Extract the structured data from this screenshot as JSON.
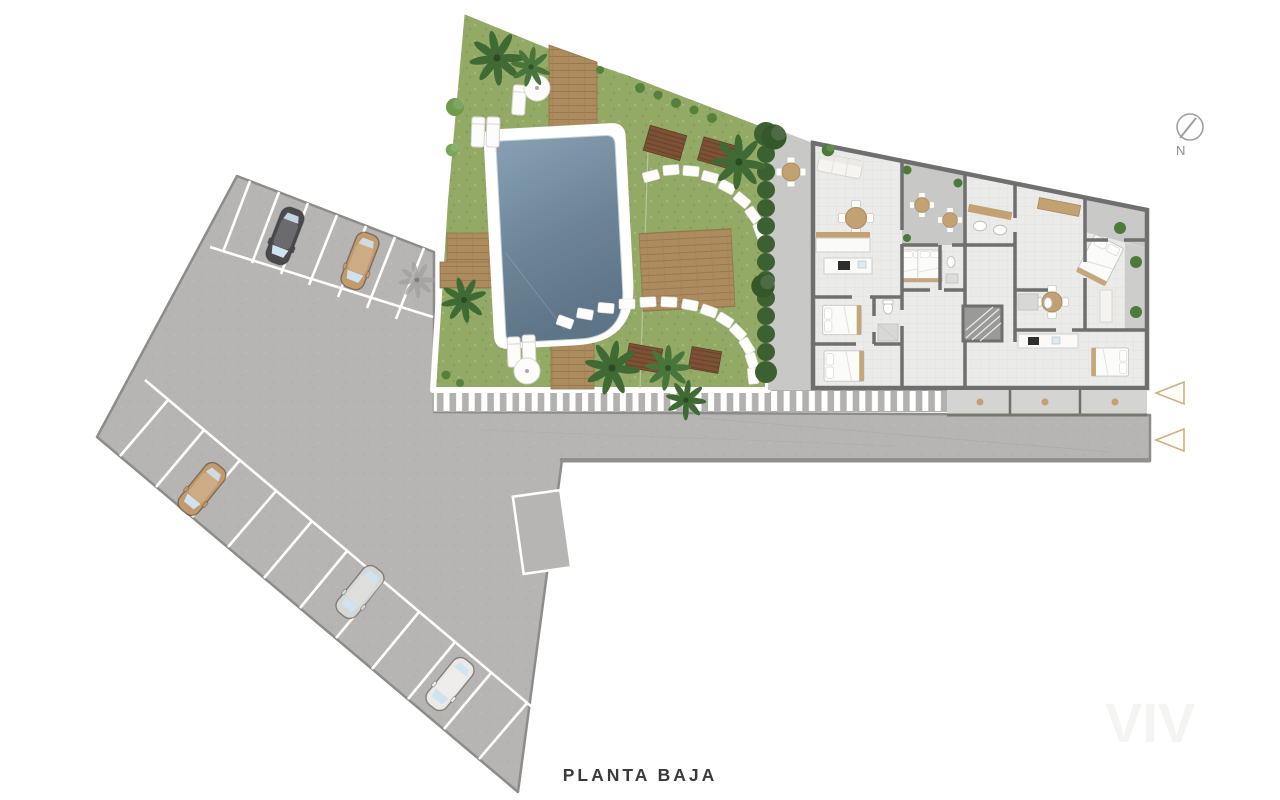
{
  "meta": {
    "plan_label": "PLANTA BAJA",
    "compass_label": "N",
    "watermark": "VIV"
  },
  "colors": {
    "background": "#ffffff",
    "paving_grey": "#b6b5b3",
    "paving_edge": "#8d8c8a",
    "stall_line_white": "#ffffff",
    "grass_green": "#92aa66",
    "pool_water_top": "#87a0b2",
    "pool_water_bottom": "#5e7487",
    "pool_ring_white": "#ffffff",
    "deck_wood": "#ac8c5f",
    "pergola_brown": "#7c5134",
    "building_wall": "#6f6f6f",
    "building_floor": "#ebebe9",
    "terrace_grey": "#c8c8c6",
    "furniture_tan": "#c2a173",
    "entry_arrow_gold": "#c9b287",
    "title_text": "#3a3a3a",
    "compass_grey": "#9a9a98"
  },
  "parking": {
    "rows": 2,
    "marked_empty_bay": true,
    "cars": [
      {
        "label": "dark-grey-car",
        "color": "#4b4b4d",
        "transform": "translate(285,236) rotate(201)"
      },
      {
        "label": "tan-car",
        "color": "#c29a6b",
        "transform": "translate(360,261) rotate(201)"
      },
      {
        "label": "tan-car",
        "color": "#c29a6b",
        "transform": "translate(202,489) rotate(219)"
      },
      {
        "label": "silver-car",
        "color": "#d7d7d5",
        "transform": "translate(360,592) rotate(219)"
      },
      {
        "label": "white-car",
        "color": "#eceae7",
        "transform": "translate(450,684) rotate(219)"
      }
    ]
  },
  "entrance": {
    "arrows": [
      {
        "transform": "translate(1170,393)"
      },
      {
        "transform": "translate(1170,440)"
      }
    ]
  }
}
